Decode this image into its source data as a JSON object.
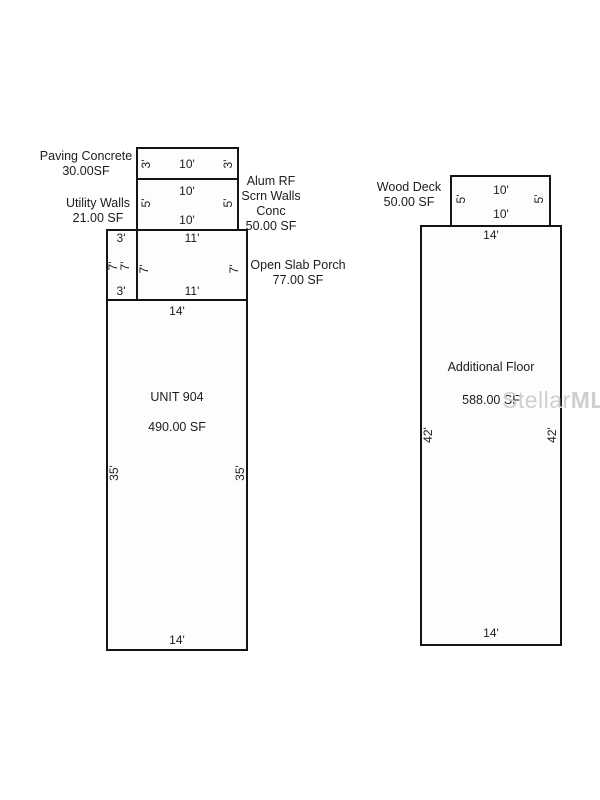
{
  "plan": {
    "areas": {
      "paving": {
        "label": [
          "Paving Concrete",
          "30.00SF"
        ],
        "dims": {
          "left": "3'",
          "center": "10'",
          "right": "3'"
        }
      },
      "alum": {
        "label": [
          "Alum RF",
          "Scrn Walls",
          "Conc",
          "50.00 SF"
        ],
        "dims": {
          "top": "10'",
          "left": "5'",
          "right": "5'",
          "bottom": "10'"
        }
      },
      "utility": {
        "label": [
          "Utility Walls",
          "21.00 SF"
        ],
        "dims": {
          "top": "3'",
          "left": "7'",
          "right": "7'",
          "bottom": "3'"
        }
      },
      "porch": {
        "label": [
          "Open Slab Porch",
          "77.00 SF"
        ],
        "dims": {
          "top": "11'",
          "left": "7'",
          "right": "7'",
          "bottom": "11'"
        }
      },
      "unit": {
        "name": "UNIT 904",
        "area": "490.00 SF",
        "dims": {
          "top": "14'",
          "left": "35'",
          "right": "35'",
          "bottom": "14'"
        }
      },
      "deck": {
        "label": [
          "Wood Deck",
          "50.00 SF"
        ],
        "dims": {
          "top": "10'",
          "left": "5'",
          "right": "5'",
          "bottom": "10'"
        }
      },
      "floor": {
        "name": "Additional Floor",
        "area": "588.00 SF",
        "dims": {
          "top": "14'",
          "left": "42'",
          "right": "42'",
          "bottom": "14'"
        }
      }
    },
    "watermark": {
      "part1": "Stellar",
      "part2": "MLS"
    },
    "colors": {
      "outline": "#141414",
      "fill": "#fdfdfc",
      "text": "#1c1c1c",
      "watermark": "#cfcfd2"
    }
  }
}
